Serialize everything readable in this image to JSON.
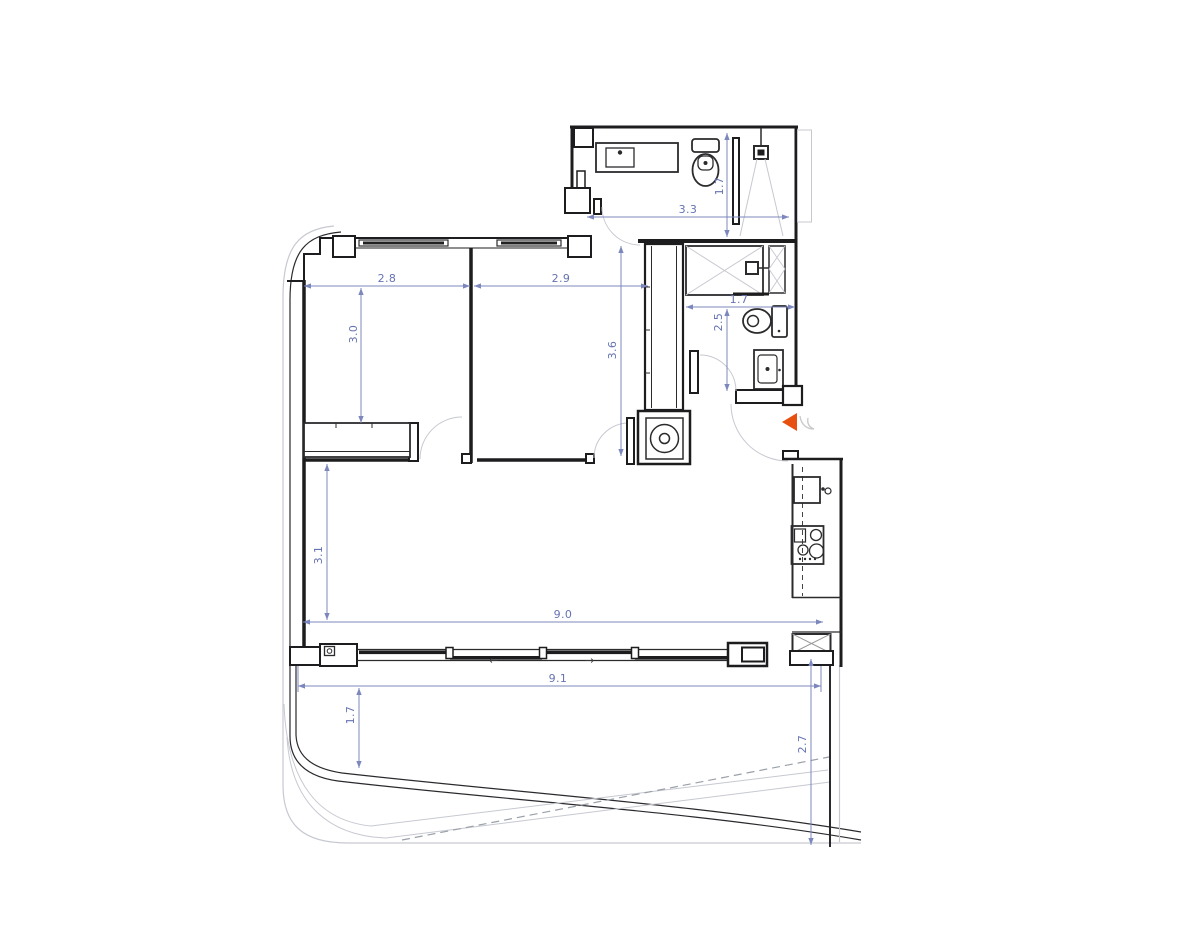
{
  "colors": {
    "wall": "#1d1d1f",
    "light_line": "#c7c9d1",
    "dimension": "#6673b3",
    "accent_arrow": "#e8500f",
    "background": "#ffffff"
  },
  "dims": {
    "bath1_width": "3.3",
    "bath1_depth": "1.7",
    "bedroom1_width": "2.8",
    "bedroom2_width": "2.9",
    "bedroom1_depth": "3.0",
    "hall_depth": "3.6",
    "bath2_width": "1.7",
    "bath2_depth": "2.5",
    "living_depth": "3.1",
    "living_width": "9.0",
    "terrace_width": "9.1",
    "terrace_depth_left": "1.7",
    "terrace_depth_right": "2.7"
  },
  "window": {
    "slide_arrow_left": "←",
    "slide_arrow_right": "→"
  }
}
